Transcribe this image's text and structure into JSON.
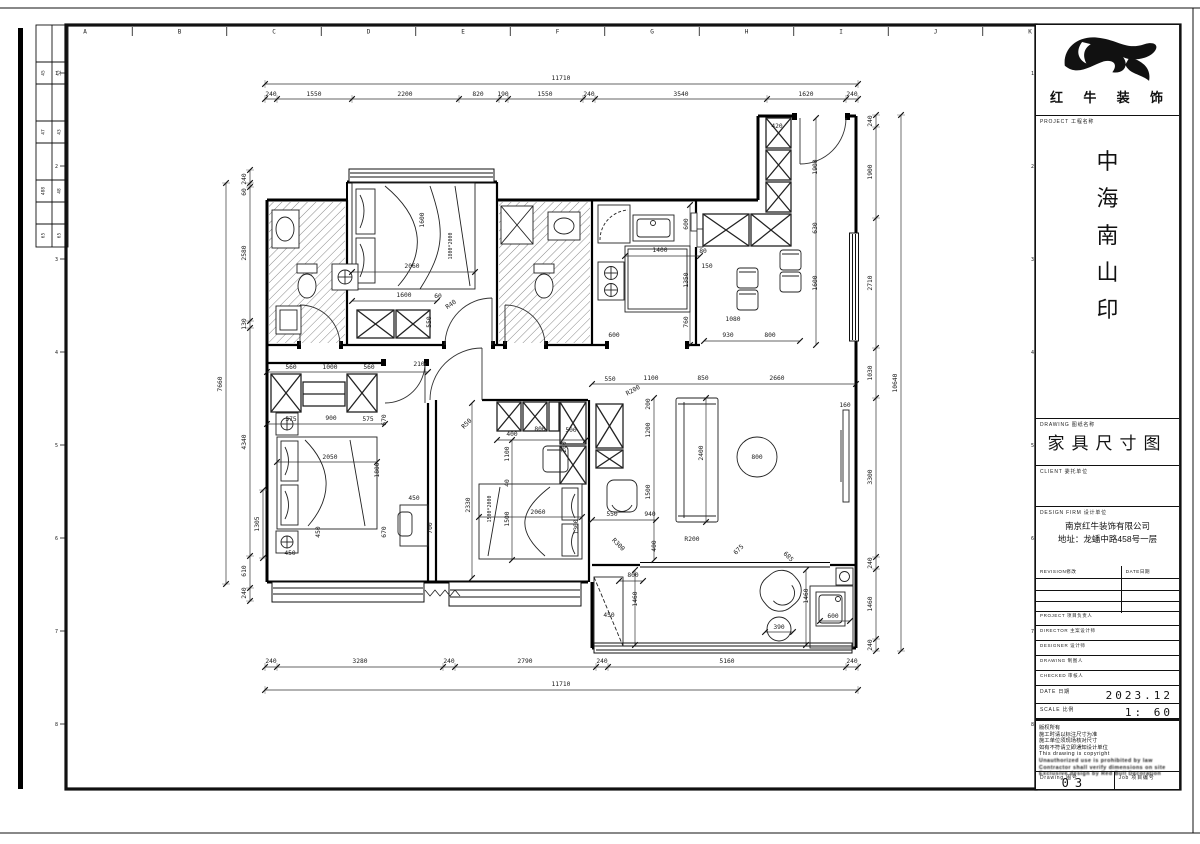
{
  "sheet": {
    "grid_letters": [
      "A",
      "B",
      "C",
      "D",
      "E",
      "F",
      "G",
      "H",
      "I",
      "J",
      "K"
    ],
    "row_numbers": [
      "1",
      "2",
      "3",
      "4",
      "5",
      "6",
      "7",
      "8"
    ]
  },
  "left_table": {
    "rows": [
      [
        "45",
        "52"
      ],
      [
        "47",
        "43"
      ],
      [
        "488",
        "48"
      ],
      [
        "65",
        "65"
      ]
    ]
  },
  "title_block": {
    "logo_text_chars": [
      "红",
      "牛",
      "装",
      "饰"
    ],
    "project_label": "PROJECT 工程名称",
    "project_name_chars": [
      "中",
      "海",
      "南",
      "山",
      "印"
    ],
    "drawing_label": "DRAWING 图纸名称",
    "drawing_title": "家具尺寸图",
    "client_label": "CLIENT 委托单位",
    "design_label": "DESIGN FIRM 设计单位",
    "design_firm_line1": "南京红牛装饰有限公司",
    "design_firm_line2": "地址：龙蟠中路458号一层",
    "revision_label": "REVISION修改",
    "date_col_label": "DATE日期",
    "staff_rows": [
      {
        "label": "PROJECT 项目负责人"
      },
      {
        "label": "DIRECTOR 主案设计师"
      },
      {
        "label": "DESIGNER 设计师"
      },
      {
        "label": "DRAWING 制图人"
      },
      {
        "label": "CHECKED 审核人"
      }
    ],
    "date_label": "DATE 日期",
    "date_value": "2023.12",
    "scale_label": "SCALE 比例",
    "scale_value": "1: 60",
    "notes": [
      "版权所有",
      "施工时请以标注尺寸为准",
      "施工单位须现场核对尺寸",
      "如有不符请立即通知设计单位",
      "This drawing is copyright",
      "Unauthorized use is prohibited by law",
      "Contractor shall verify dimensions on site",
      "Exclusive design by Red Bull Decoration"
    ],
    "drawing_no_label": "Drawing 图号",
    "drawing_no": "03",
    "job_label": "Job 项目编号"
  },
  "plan": {
    "dims": [
      [
        "11710",
        561,
        80
      ],
      [
        "240",
        271,
        96
      ],
      [
        "1550",
        314,
        96
      ],
      [
        "2200",
        405,
        96
      ],
      [
        "820",
        478,
        96
      ],
      [
        "190",
        503,
        96
      ],
      [
        "1550",
        545,
        96
      ],
      [
        "240",
        589,
        96
      ],
      [
        "3540",
        681,
        96
      ],
      [
        "1620",
        806,
        96
      ],
      [
        "240",
        852,
        96
      ],
      [
        "240",
        271,
        663
      ],
      [
        "3280",
        360,
        663
      ],
      [
        "240",
        449,
        663
      ],
      [
        "2790",
        525,
        663
      ],
      [
        "240",
        602,
        663
      ],
      [
        "5160",
        727,
        663
      ],
      [
        "240",
        852,
        663
      ],
      [
        "11710",
        561,
        686
      ],
      [
        "240",
        246,
        179,
        "v"
      ],
      [
        "60",
        246,
        192,
        "v"
      ],
      [
        "2580",
        246,
        253,
        "v"
      ],
      [
        "130",
        246,
        324,
        "v"
      ],
      [
        "4340",
        246,
        442,
        "v"
      ],
      [
        "610",
        246,
        571,
        "v"
      ],
      [
        "240",
        246,
        593,
        "v"
      ],
      [
        "7660",
        222,
        384,
        "v"
      ],
      [
        "1305",
        259,
        524,
        "v"
      ],
      [
        "240",
        872,
        121,
        "v"
      ],
      [
        "1900",
        872,
        172,
        "v"
      ],
      [
        "2710",
        872,
        283,
        "v"
      ],
      [
        "1030",
        872,
        373,
        "v"
      ],
      [
        "3300",
        872,
        477,
        "v"
      ],
      [
        "240",
        872,
        563,
        "v"
      ],
      [
        "1460",
        872,
        604,
        "v"
      ],
      [
        "240",
        872,
        645,
        "v"
      ],
      [
        "10640",
        897,
        383,
        "v"
      ],
      [
        "1600",
        424,
        220,
        "v"
      ],
      [
        "1800*2000",
        452,
        246,
        "v",
        5
      ],
      [
        "2060",
        412,
        268
      ],
      [
        "1600",
        404,
        297
      ],
      [
        "60",
        438,
        298
      ],
      [
        "R40",
        452,
        306,
        -35
      ],
      [
        "550",
        431,
        322,
        "v"
      ],
      [
        "560",
        291,
        369
      ],
      [
        "1000",
        330,
        369
      ],
      [
        "560",
        369,
        369
      ],
      [
        "210",
        419,
        366
      ],
      [
        "575",
        291,
        421
      ],
      [
        "900",
        331,
        420
      ],
      [
        "575",
        368,
        421
      ],
      [
        "670",
        386,
        420,
        "v"
      ],
      [
        "2050",
        330,
        459
      ],
      [
        "1800",
        379,
        470,
        "v"
      ],
      [
        "670",
        386,
        532,
        "v"
      ],
      [
        "450",
        320,
        532,
        "v"
      ],
      [
        "450",
        290,
        555
      ],
      [
        "450",
        414,
        500
      ],
      [
        "700",
        432,
        528,
        "v"
      ],
      [
        "2330",
        470,
        505,
        "v"
      ],
      [
        "R50",
        468,
        425,
        -45
      ],
      [
        "400",
        512,
        436
      ],
      [
        "800",
        540,
        431
      ],
      [
        "500",
        571,
        432
      ],
      [
        "1100",
        509,
        454,
        "v"
      ],
      [
        "200",
        566,
        447,
        "v"
      ],
      [
        "40",
        509,
        483,
        "v"
      ],
      [
        "1500",
        509,
        519,
        "v"
      ],
      [
        "1500*2000",
        491,
        509,
        "v",
        5
      ],
      [
        "2060",
        538,
        514
      ],
      [
        "1300",
        578,
        527,
        "v"
      ],
      [
        "600",
        688,
        224,
        "v"
      ],
      [
        "1400",
        660,
        252
      ],
      [
        "80",
        703,
        253
      ],
      [
        "150",
        707,
        268
      ],
      [
        "1350",
        688,
        280,
        "v"
      ],
      [
        "760",
        688,
        322,
        "v"
      ],
      [
        "600",
        614,
        337
      ],
      [
        "1080",
        733,
        321
      ],
      [
        "930",
        728,
        337
      ],
      [
        "800",
        770,
        337
      ],
      [
        "420",
        777,
        128
      ],
      [
        "1900",
        817,
        167,
        "v"
      ],
      [
        "630",
        817,
        228,
        "v"
      ],
      [
        "1600",
        817,
        283,
        "v"
      ],
      [
        "550",
        610,
        381
      ],
      [
        "1100",
        651,
        380
      ],
      [
        "850",
        703,
        380
      ],
      [
        "2660",
        777,
        380
      ],
      [
        "R200",
        634,
        392,
        -30
      ],
      [
        "200",
        650,
        404,
        "v"
      ],
      [
        "1200",
        650,
        430,
        "v"
      ],
      [
        "1500",
        650,
        492,
        "v"
      ],
      [
        "2400",
        703,
        453,
        "v"
      ],
      [
        "800",
        757,
        459
      ],
      [
        "160",
        845,
        407
      ],
      [
        "550",
        612,
        516
      ],
      [
        "940",
        650,
        516
      ],
      [
        "R300",
        617,
        546,
        45
      ],
      [
        "400",
        656,
        546,
        "v"
      ],
      [
        "R200",
        692,
        541
      ],
      [
        "800",
        633,
        577
      ],
      [
        "1460",
        637,
        599,
        "v"
      ],
      [
        "450",
        609,
        617
      ],
      [
        "675",
        740,
        551,
        -45
      ],
      [
        "685",
        787,
        558,
        45
      ],
      [
        "1460",
        808,
        596,
        "v"
      ],
      [
        "390",
        779,
        629
      ],
      [
        "600",
        833,
        618
      ]
    ]
  }
}
